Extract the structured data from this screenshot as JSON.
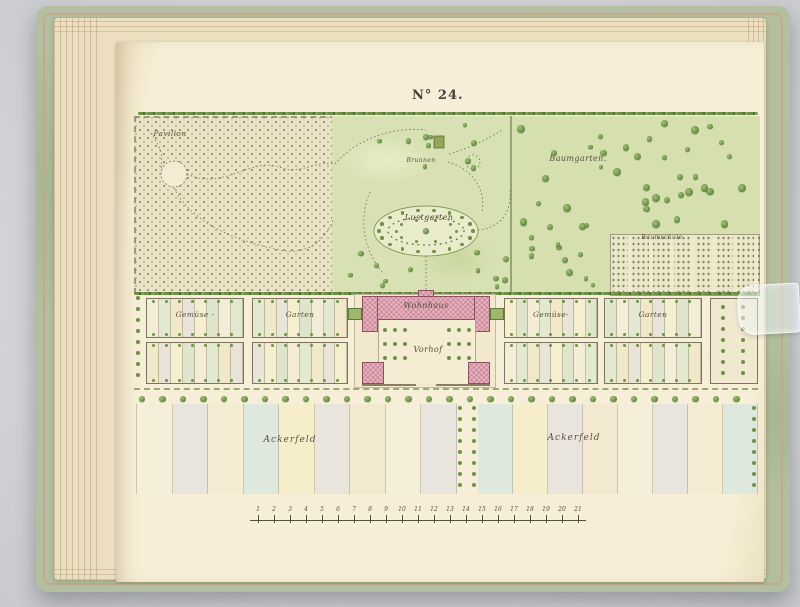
{
  "photo": {
    "background_color": "#d2d3d6"
  },
  "book": {
    "cover_color": "#b3bfa0",
    "page_color": "#f6eed6"
  },
  "plate": {
    "title": "N° 24.",
    "labels": {
      "pavillon": "Pavillon",
      "brunnen": "Brunnen",
      "baumgarten": "Baumgarten.",
      "lustgarten": "Lustgarten",
      "baumschule": "Baumschule",
      "gemuese_left": "Gemüse -",
      "garten_left": "Garten",
      "wohnhaus": "Wohnhaus",
      "vorhof": "Vorhof",
      "gemuese_right": "Gemüse-",
      "garten_right": "Garten",
      "ackerfeld_left": "Ackerfeld",
      "ackerfeld_right": "Ackerfeld"
    },
    "scale_bar": {
      "numbers": [
        "1",
        "2",
        "3",
        "4",
        "5",
        "6",
        "7",
        "8",
        "9",
        "10",
        "11",
        "12",
        "13",
        "14",
        "15",
        "16",
        "17",
        "18",
        "19",
        "20",
        "21"
      ]
    },
    "colors": {
      "ink": "#57513f",
      "park_green": "#d8e1b4",
      "baumgarten_green": "#d6e0ae",
      "tree_green": "#6d9149",
      "building_pink": "#e7b2be",
      "field_palette": [
        "#f5eed9",
        "#e8e4de",
        "#f3ecd3",
        "#dfe8dc",
        "#f6eecb",
        "#eae5dc",
        "#f2e9d0"
      ],
      "bed_palette": [
        "#f4edd6",
        "#e3e8d0",
        "#f1e8ca",
        "#e8e4d8",
        "#f6efcf",
        "#dfe5cc"
      ]
    }
  }
}
